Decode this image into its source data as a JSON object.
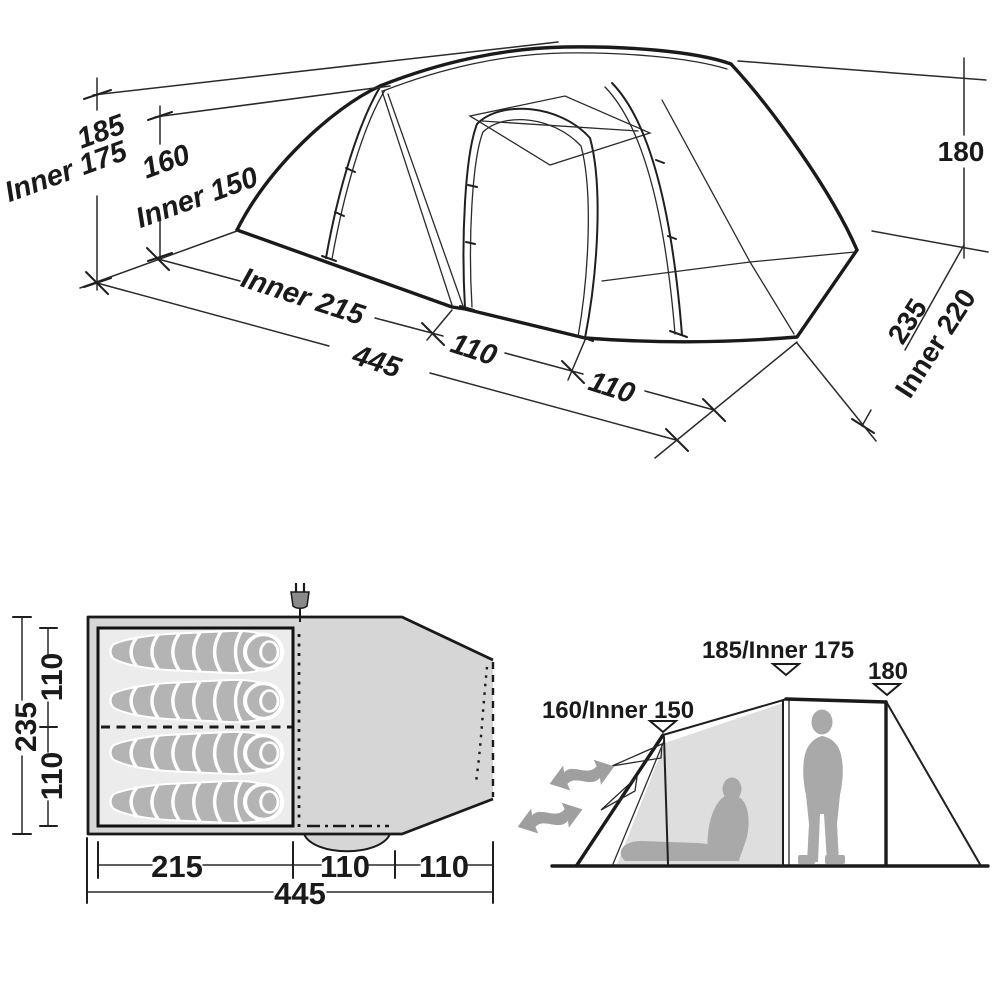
{
  "colors": {
    "line": "#1a1a1a",
    "floor_outer_fill": "#d6d6d6",
    "floor_inner_fill": "#ececec",
    "sleeping_bag_fill": "#b4b4b4",
    "wall_fill": "#dedede",
    "figure_fill": "#a9a9a9",
    "arrow_fill": "#9f9f9f",
    "plug_fill": "#8a8a8a"
  },
  "perspective_view": {
    "dim_height_main": "185",
    "dim_height_main_inner": "Inner 175",
    "dim_height_front": "160",
    "dim_height_front_inner": "Inner 150",
    "dim_height_rear": "180",
    "dim_length_inner": "Inner 215",
    "dim_length_mid": "110",
    "dim_length_front": "110",
    "dim_length_total": "445",
    "dim_width": "235",
    "dim_width_inner": "Inner 220"
  },
  "floor_plan": {
    "dim_width_total": "235",
    "dim_berth_top": "110",
    "dim_berth_bottom": "110",
    "dim_length_inner": "215",
    "dim_length_mid": "110",
    "dim_length_front": "110",
    "dim_length_total": "445",
    "sleeping_bag_count": 4,
    "power_plug_icon": "power-plug"
  },
  "side_view": {
    "label_front_height": "160/Inner 150",
    "label_main_height": "185/Inner 175",
    "label_rear_height": "180"
  }
}
